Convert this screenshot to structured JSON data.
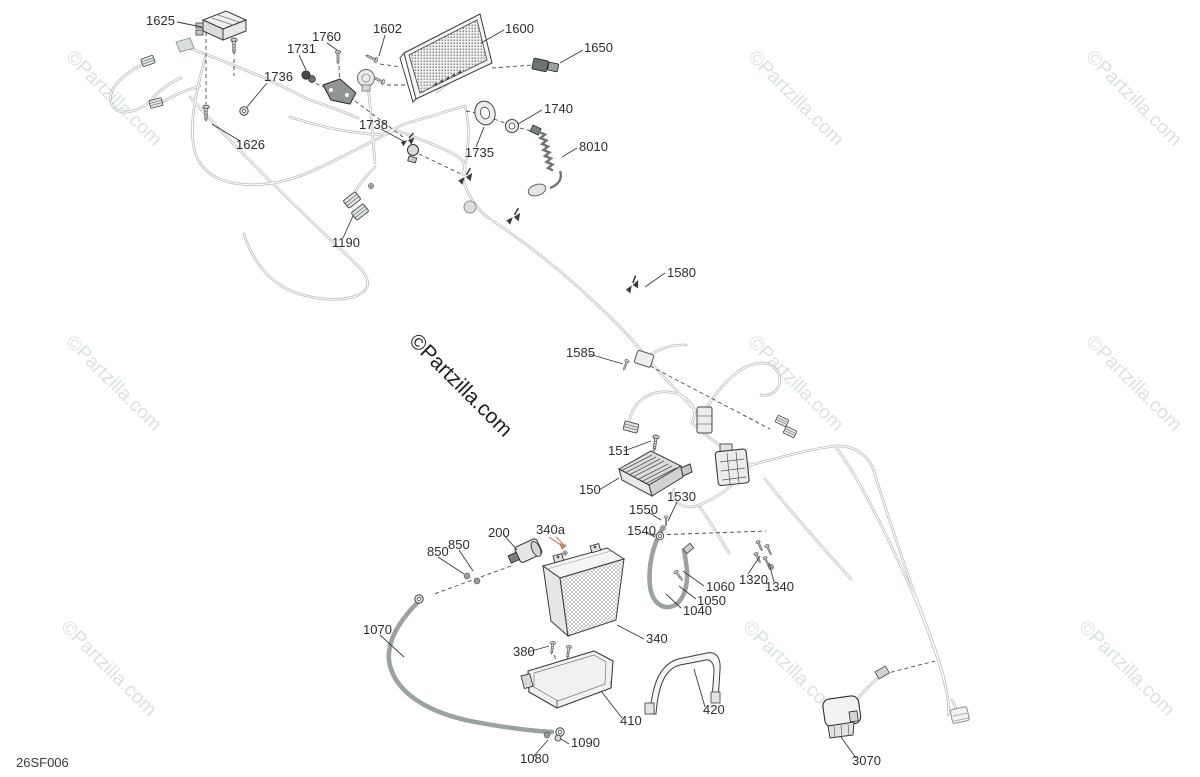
{
  "page": {
    "diagram_code": "26SF006",
    "background": "#ffffff"
  },
  "watermark": {
    "text": "©Partzilla.com",
    "light_positions": [
      {
        "x": 65,
        "y": 58
      },
      {
        "x": 747,
        "y": 58
      },
      {
        "x": 1085,
        "y": 58
      },
      {
        "x": 65,
        "y": 343
      },
      {
        "x": 747,
        "y": 343
      },
      {
        "x": 1085,
        "y": 343
      },
      {
        "x": 60,
        "y": 628
      },
      {
        "x": 742,
        "y": 628
      },
      {
        "x": 1078,
        "y": 628
      }
    ],
    "dark_position": {
      "x": 408,
      "y": 342
    }
  },
  "colors": {
    "harness": "#b6bcbc",
    "label": "#2e2e2e",
    "leader": "#3a3a3a",
    "dash": "#4a4a4a",
    "highlight": "#c9826a",
    "wm_light": "#dae2e3",
    "wm_dark": "#1e1e1e"
  },
  "callouts": [
    {
      "label": "1625",
      "x": 146,
      "y": 25
    },
    {
      "label": "1760",
      "x": 312,
      "y": 41
    },
    {
      "label": "1602",
      "x": 373,
      "y": 33
    },
    {
      "label": "1600",
      "x": 505,
      "y": 33
    },
    {
      "label": "1650",
      "x": 584,
      "y": 52
    },
    {
      "label": "1731",
      "x": 287,
      "y": 53
    },
    {
      "label": "1736",
      "x": 264,
      "y": 81
    },
    {
      "label": "1740",
      "x": 544,
      "y": 113
    },
    {
      "label": "1738",
      "x": 359,
      "y": 129
    },
    {
      "label": "1735",
      "x": 465,
      "y": 157
    },
    {
      "label": "8010",
      "x": 579,
      "y": 151
    },
    {
      "label": "1626",
      "x": 236,
      "y": 149
    },
    {
      "label": "1190",
      "x": 332,
      "y": 247
    },
    {
      "label": "1580",
      "x": 667,
      "y": 277
    },
    {
      "label": "1585",
      "x": 566,
      "y": 357
    },
    {
      "label": "151",
      "x": 608,
      "y": 455
    },
    {
      "label": "150",
      "x": 579,
      "y": 494
    },
    {
      "label": "1530",
      "x": 667,
      "y": 501
    },
    {
      "label": "1550",
      "x": 629,
      "y": 514
    },
    {
      "label": "1540",
      "x": 627,
      "y": 535
    },
    {
      "label": "200",
      "x": 488,
      "y": 537
    },
    {
      "label": "340a",
      "x": 536,
      "y": 534
    },
    {
      "label": "850",
      "x": 427,
      "y": 556
    },
    {
      "label": "850",
      "x": 448,
      "y": 549
    },
    {
      "label": "1320",
      "x": 739,
      "y": 584
    },
    {
      "label": "1340",
      "x": 765,
      "y": 591
    },
    {
      "label": "1060",
      "x": 706,
      "y": 591
    },
    {
      "label": "1050",
      "x": 697,
      "y": 605
    },
    {
      "label": "1040",
      "x": 683,
      "y": 615
    },
    {
      "label": "1070",
      "x": 363,
      "y": 634
    },
    {
      "label": "340",
      "x": 646,
      "y": 643
    },
    {
      "label": "380",
      "x": 513,
      "y": 656
    },
    {
      "label": "410",
      "x": 620,
      "y": 725
    },
    {
      "label": "420",
      "x": 703,
      "y": 714
    },
    {
      "label": "1090",
      "x": 571,
      "y": 747
    },
    {
      "label": "1080",
      "x": 520,
      "y": 763
    },
    {
      "label": "3070",
      "x": 852,
      "y": 765
    }
  ]
}
